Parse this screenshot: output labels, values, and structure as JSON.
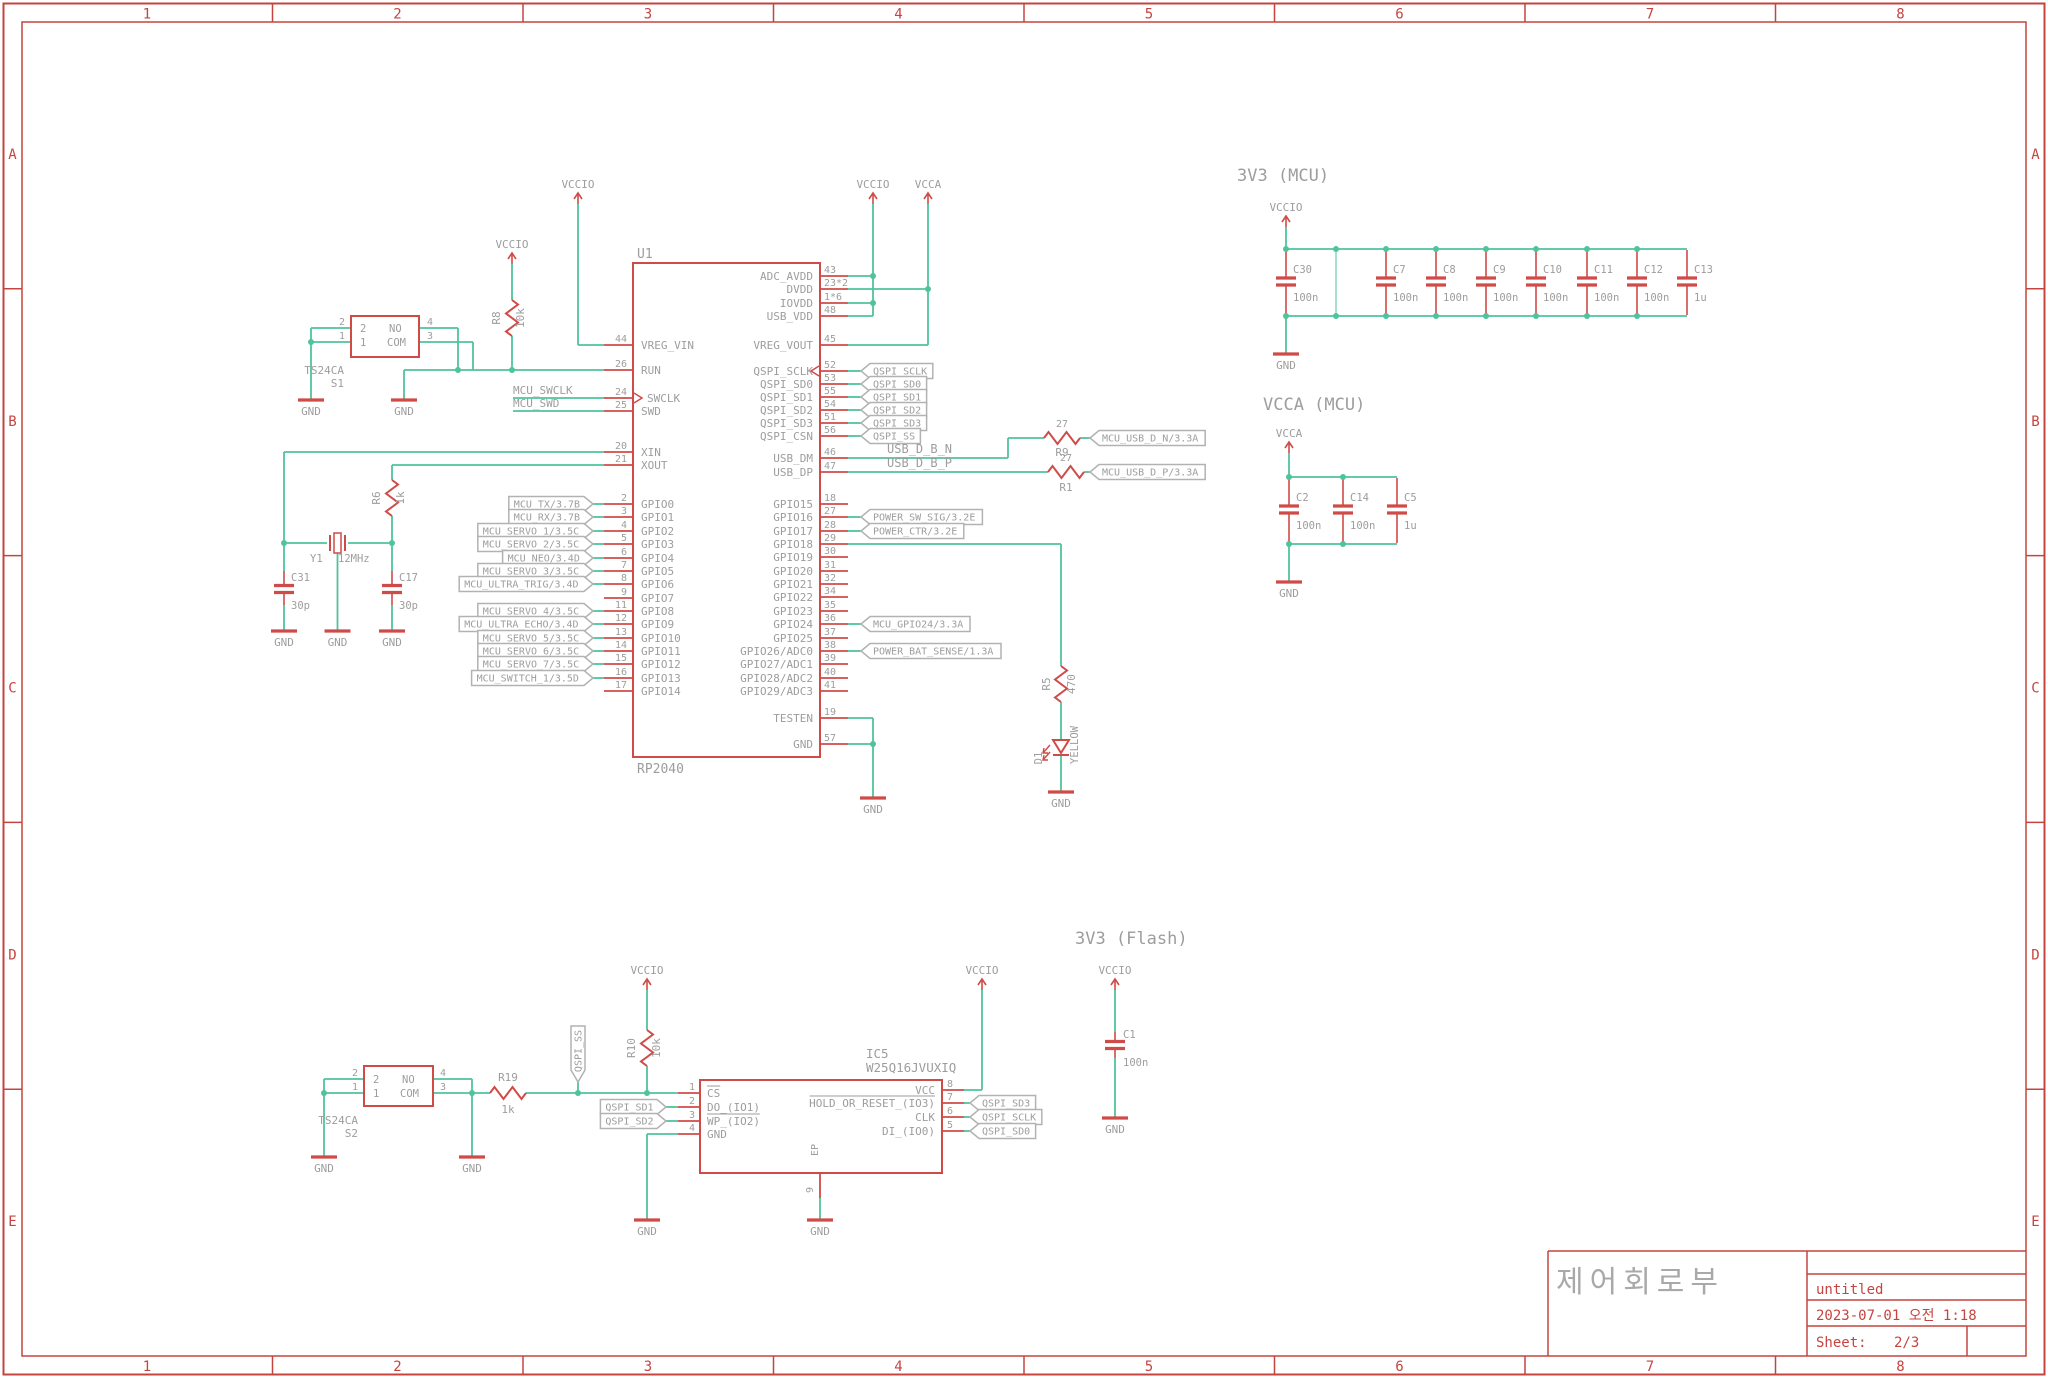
{
  "colors": {
    "symbol": "#cf4b47",
    "wire": "#4fc39d",
    "text": "#9d9d9d",
    "frame": "#c5443f",
    "box_border": "#b2b2b2"
  },
  "frame": {
    "columns": [
      "1",
      "2",
      "3",
      "4",
      "5",
      "6",
      "7",
      "8"
    ],
    "rows": [
      "A",
      "B",
      "C",
      "D",
      "E"
    ]
  },
  "title_block": {
    "title": "제어회로부",
    "doc": "untitled",
    "date": "2023-07-01 오전 1:18",
    "sheet_label": "Sheet:",
    "sheet": "2/3"
  },
  "headings": {
    "mcu": "3V3 (MCU)",
    "vcca": "VCCA (MCU)",
    "flash": "3V3 (Flash)"
  },
  "nets": {
    "vccio": "VCCIO",
    "vcca": "VCCA",
    "gnd": "GND"
  },
  "u1": {
    "ref": "U1",
    "value": "RP2040",
    "left_pins": [
      {
        "num": "44",
        "name": "VREG_VIN"
      },
      {
        "num": "26",
        "name": "RUN"
      },
      {
        "num": "24",
        "name": "SWCLK"
      },
      {
        "num": "25",
        "name": "SWD"
      },
      {
        "num": "20",
        "name": "XIN"
      },
      {
        "num": "21",
        "name": "XOUT"
      },
      {
        "num": "2",
        "name": "GPIO0",
        "label": "MCU_TX/3.7B"
      },
      {
        "num": "3",
        "name": "GPIO1",
        "label": "MCU_RX/3.7B"
      },
      {
        "num": "4",
        "name": "GPIO2",
        "label": "MCU_SERVO_1/3.5C"
      },
      {
        "num": "5",
        "name": "GPIO3",
        "label": "MCU_SERVO_2/3.5C"
      },
      {
        "num": "6",
        "name": "GPIO4",
        "label": "MCU_NEO/3.4D"
      },
      {
        "num": "7",
        "name": "GPIO5",
        "label": "MCU_SERVO_3/3.5C"
      },
      {
        "num": "8",
        "name": "GPIO6",
        "label": "MCU_ULTRA_TRIG/3.4D"
      },
      {
        "num": "9",
        "name": "GPIO7"
      },
      {
        "num": "11",
        "name": "GPIO8",
        "label": "MCU_SERVO_4/3.5C"
      },
      {
        "num": "12",
        "name": "GPIO9",
        "label": "MCU_ULTRA_ECHO/3.4D"
      },
      {
        "num": "13",
        "name": "GPIO10",
        "label": "MCU_SERVO_5/3.5C"
      },
      {
        "num": "14",
        "name": "GPIO11",
        "label": "MCU_SERVO_6/3.5C"
      },
      {
        "num": "15",
        "name": "GPIO12",
        "label": "MCU_SERVO_7/3.5C"
      },
      {
        "num": "16",
        "name": "GPIO13",
        "label": "MCU_SWITCH_1/3.5D"
      },
      {
        "num": "17",
        "name": "GPIO14"
      }
    ],
    "right_pins": [
      {
        "num": "43",
        "name": "ADC_AVDD"
      },
      {
        "num": "23*2",
        "name": "DVDD"
      },
      {
        "num": "1*6",
        "name": "IOVDD"
      },
      {
        "num": "48",
        "name": "USB_VDD"
      },
      {
        "num": "45",
        "name": "VREG_VOUT"
      },
      {
        "num": "52",
        "name": "QSPI_SCLK",
        "label": "QSPI_SCLK"
      },
      {
        "num": "53",
        "name": "QSPI_SD0",
        "label": "QSPI_SD0"
      },
      {
        "num": "55",
        "name": "QSPI_SD1",
        "label": "QSPI_SD1"
      },
      {
        "num": "54",
        "name": "QSPI_SD2",
        "label": "QSPI_SD2"
      },
      {
        "num": "51",
        "name": "QSPI_SD3",
        "label": "QSPI_SD3"
      },
      {
        "num": "56",
        "name": "QSPI_CSN",
        "label": "QSPI_SS"
      },
      {
        "num": "46",
        "name": "USB_DM"
      },
      {
        "num": "47",
        "name": "USB_DP"
      },
      {
        "num": "18",
        "name": "GPIO15"
      },
      {
        "num": "27",
        "name": "GPIO16",
        "label": "POWER_SW_SIG/3.2E"
      },
      {
        "num": "28",
        "name": "GPIO17",
        "label": "POWER_CTR/3.2E"
      },
      {
        "num": "29",
        "name": "GPIO18"
      },
      {
        "num": "30",
        "name": "GPIO19"
      },
      {
        "num": "31",
        "name": "GPIO20"
      },
      {
        "num": "32",
        "name": "GPIO21"
      },
      {
        "num": "34",
        "name": "GPIO22"
      },
      {
        "num": "35",
        "name": "GPIO23"
      },
      {
        "num": "36",
        "name": "GPIO24",
        "label": "MCU_GPIO24/3.3A"
      },
      {
        "num": "37",
        "name": "GPIO25"
      },
      {
        "num": "38",
        "name": "GPIO26/ADC0",
        "label": "POWER_BAT_SENSE/1.3A"
      },
      {
        "num": "39",
        "name": "GPIO27/ADC1"
      },
      {
        "num": "40",
        "name": "GPIO28/ADC2"
      },
      {
        "num": "41",
        "name": "GPIO29/ADC3"
      },
      {
        "num": "19",
        "name": "TESTEN"
      },
      {
        "num": "57",
        "name": "GND"
      }
    ]
  },
  "ic5": {
    "ref": "IC5",
    "value": "W25Q16JVUXIQ",
    "left_pins": [
      {
        "num": "1",
        "name": "CS",
        "bar": true
      },
      {
        "num": "2",
        "name": "DO_(IO1)"
      },
      {
        "num": "3",
        "name": "WP_(IO2)",
        "bar": true
      },
      {
        "num": "4",
        "name": "GND"
      }
    ],
    "right_pins": [
      {
        "num": "8",
        "name": "VCC"
      },
      {
        "num": "7",
        "name": "HOLD_OR_RESET_(IO3)",
        "bar": true
      },
      {
        "num": "6",
        "name": "CLK"
      },
      {
        "num": "5",
        "name": "DI_(IO0)"
      }
    ],
    "bottom_pin": {
      "num": "9",
      "name": "EP"
    }
  },
  "ic5_labels": {
    "left": [
      "QSPI_SD1",
      "QSPI_SD2"
    ],
    "right": [
      "QSPI_SD3",
      "QSPI_SCLK",
      "QSPI_SD0"
    ]
  },
  "switches": {
    "s1": {
      "ref": "S1",
      "value": "TS24CA"
    },
    "s2": {
      "ref": "S2",
      "value": "TS24CA"
    },
    "pin_rows": [
      {
        "inner_num": "2",
        "inner_name": "NO",
        "left_num": "2",
        "right_num": "4"
      },
      {
        "inner_num": "1",
        "inner_name": "COM",
        "left_num": "1",
        "right_num": "3"
      }
    ]
  },
  "resistors": {
    "r8": {
      "ref": "R8",
      "value": "10k"
    },
    "r6": {
      "ref": "R6",
      "value": "1k"
    },
    "r9": {
      "ref": "R9",
      "value": "27"
    },
    "r1": {
      "ref": "R1",
      "value": "27"
    },
    "r5": {
      "ref": "R5",
      "value": "470"
    },
    "r19": {
      "ref": "R19",
      "value": "1k"
    },
    "r10": {
      "ref": "R10",
      "value": "10k"
    }
  },
  "led": {
    "ref": "D1",
    "value": "YELLOW"
  },
  "crystal": {
    "ref": "Y1",
    "value": "12MHz",
    "c31": {
      "ref": "C31",
      "value": "30p"
    },
    "c17": {
      "ref": "C17",
      "value": "30p"
    }
  },
  "caps_3v3": [
    {
      "ref": "C30",
      "value": "100n"
    },
    {
      "ref": "C7",
      "value": "100n"
    },
    {
      "ref": "C8",
      "value": "100n"
    },
    {
      "ref": "C9",
      "value": "100n"
    },
    {
      "ref": "C10",
      "value": "100n"
    },
    {
      "ref": "C11",
      "value": "100n"
    },
    {
      "ref": "C12",
      "value": "100n"
    },
    {
      "ref": "C13",
      "value": "1u"
    }
  ],
  "caps_vcca": [
    {
      "ref": "C2",
      "value": "100n"
    },
    {
      "ref": "C14",
      "value": "100n"
    },
    {
      "ref": "C5",
      "value": "1u"
    }
  ],
  "cap_flash": {
    "ref": "C1",
    "value": "100n"
  },
  "labels": {
    "swclk": "MCU_SWCLK",
    "swd": "MCU_SWD",
    "usb_n": "USB_D_B_N",
    "usb_p": "USB_D_B_P",
    "usb_n_out": "MCU_USB_D_N/3.3A",
    "usb_p_out": "MCU_USB_D_P/3.3A",
    "qspi_ss_vert": "QSPI_SS"
  }
}
